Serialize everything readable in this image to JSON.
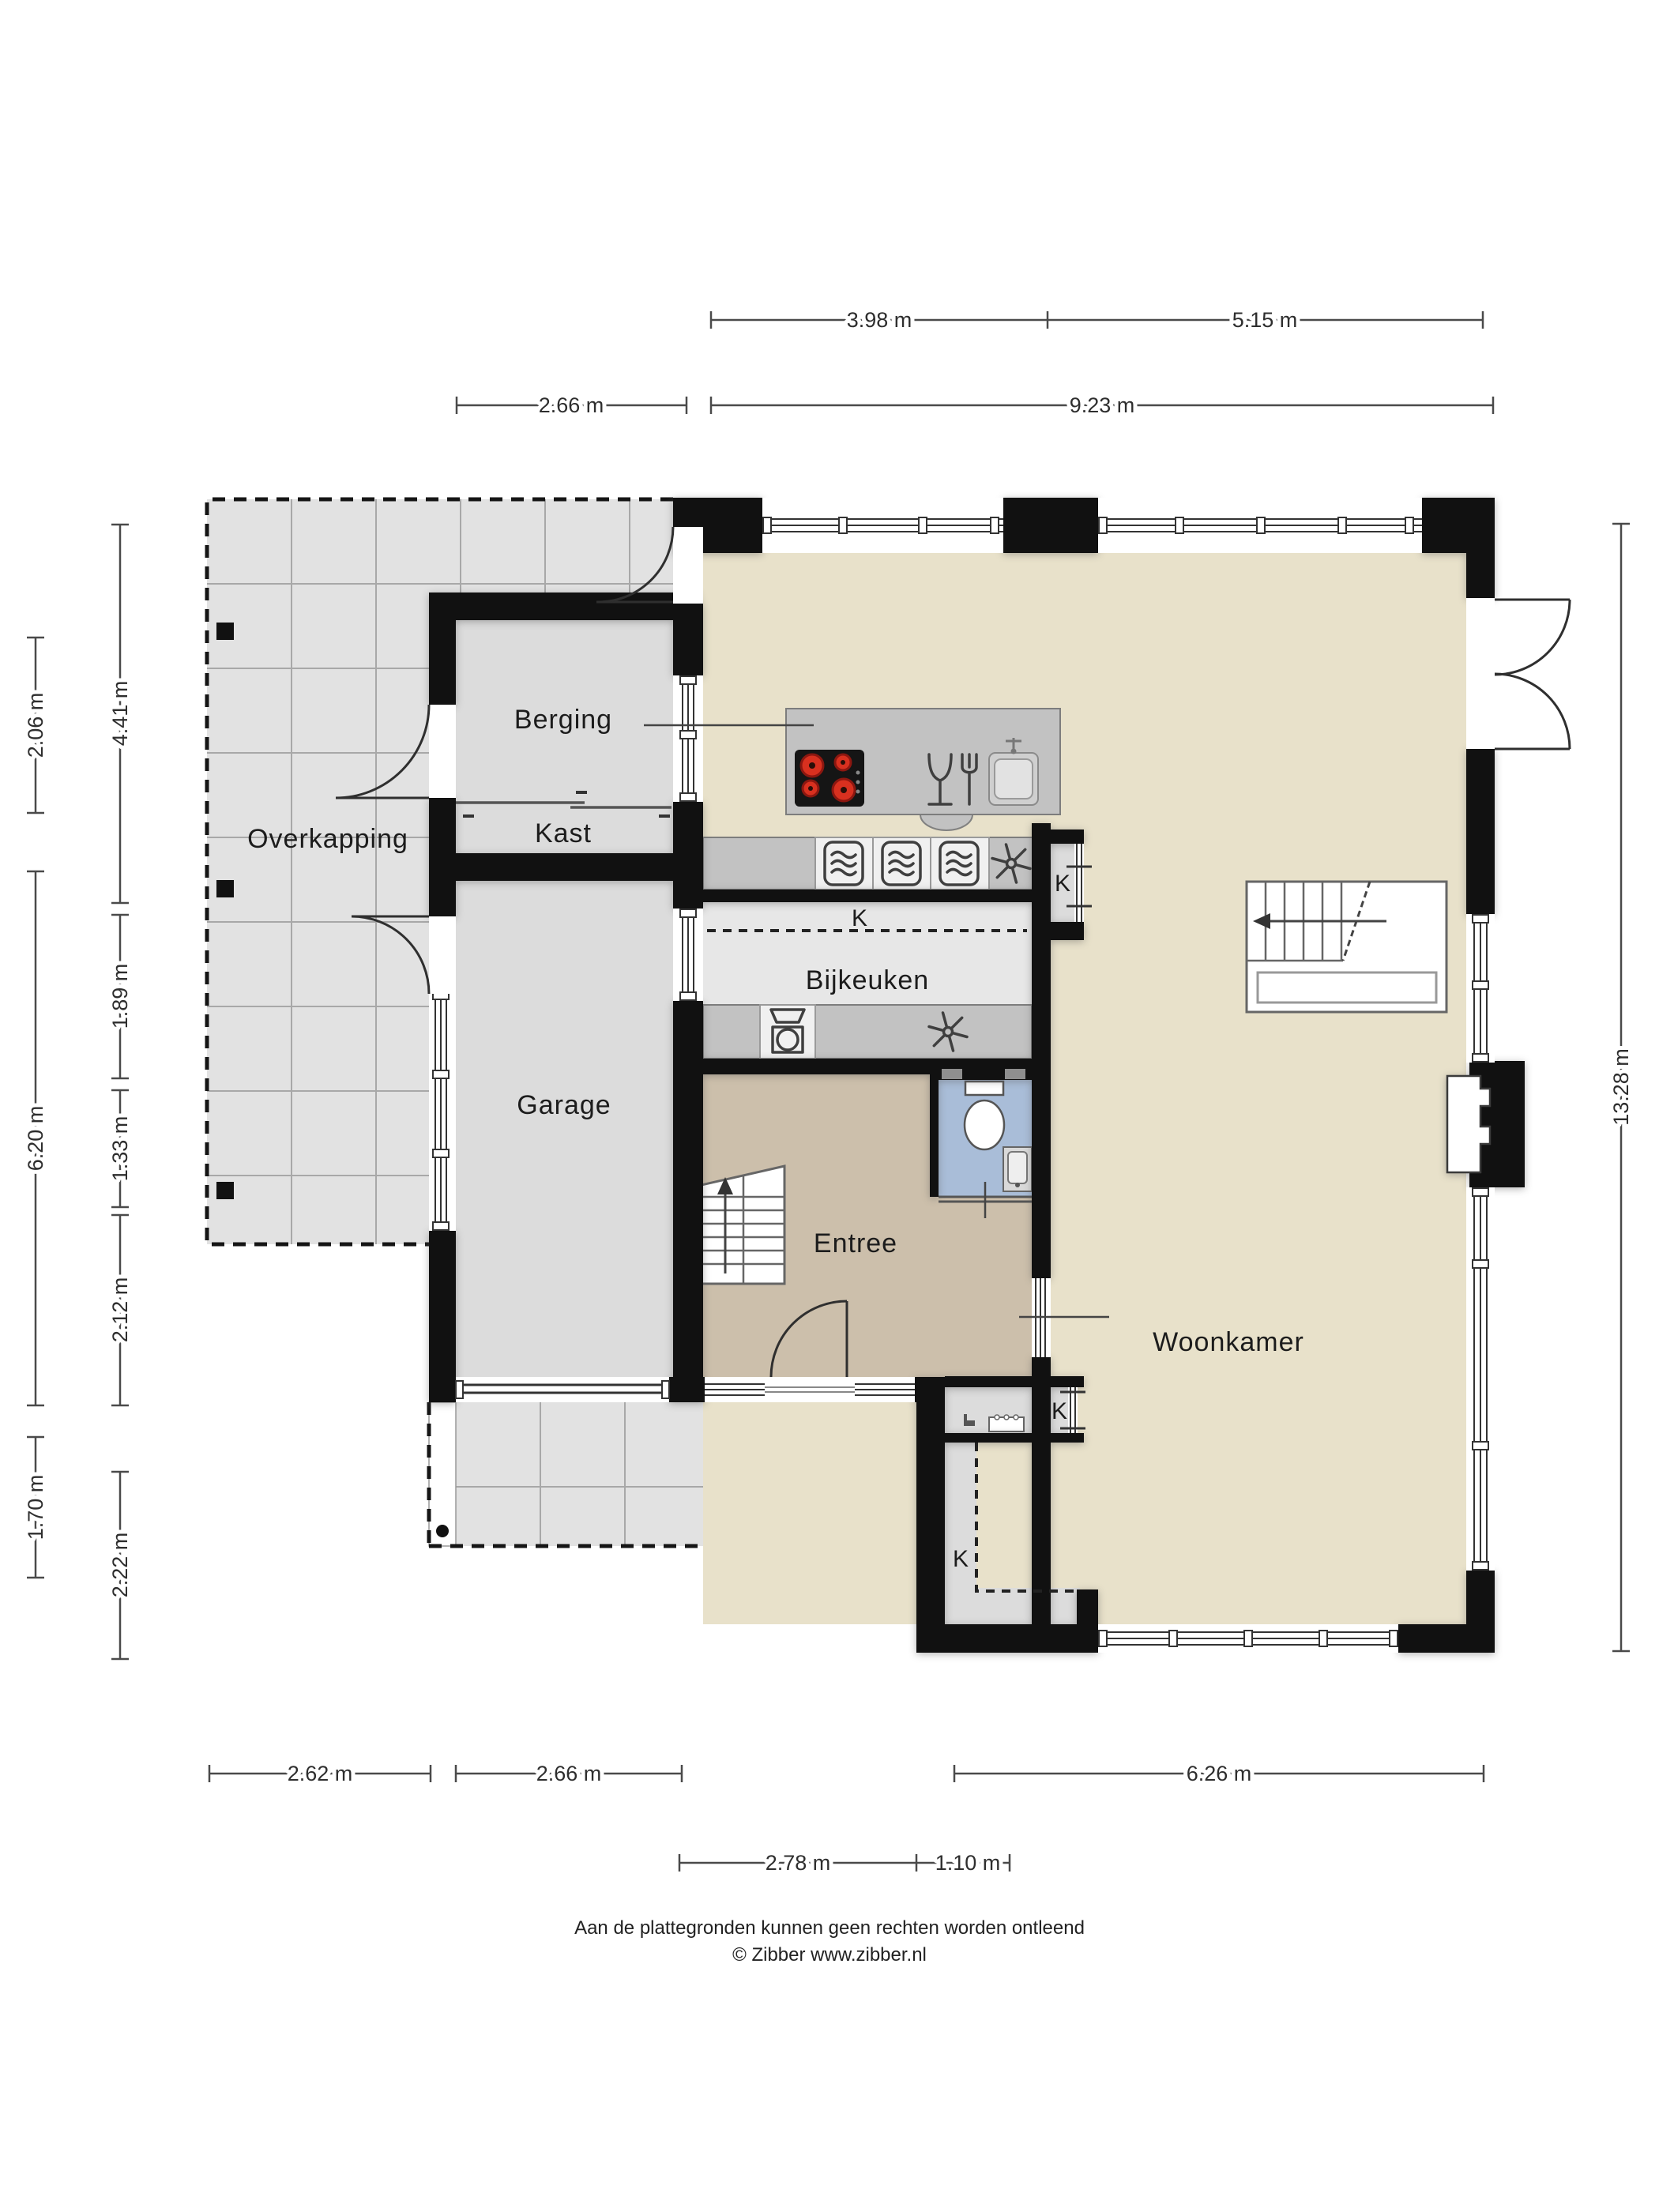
{
  "colors": {
    "wall": "#111111",
    "label": "#1c1c1c",
    "floor-living": "#e8e1ca",
    "floor-gray": "#dcdcdc",
    "floor-light": "#e7e7e7",
    "floor-entree": "#ccbfab",
    "floor-toilet": "#a9bdd8",
    "tile": "#e2e2e2",
    "tile-line": "#a8a8a8",
    "counter": "#c2c2c2",
    "appliance": "#f0f0f0",
    "burner": "#d8301f"
  },
  "rooms": {
    "overkapping": "Overkapping",
    "berging": "Berging",
    "kast": "Kast",
    "garage": "Garage",
    "bijkeuken": "Bijkeuken",
    "entree": "Entree",
    "woonkamer": "Woonkamer",
    "closet_bijkeuken": "K",
    "closet_k1": "K",
    "closet_k2": "K",
    "closet_k3": "K"
  },
  "dimensions": {
    "top_row1": [
      "3.98 m",
      "5.15 m"
    ],
    "top_row2": [
      "2.66 m",
      "9.23 m"
    ],
    "bottom_row1": [
      "2.62 m",
      "2.66 m",
      "6.26 m"
    ],
    "bottom_row2": [
      "2.78 m",
      "1.10 m"
    ],
    "left_outer": [
      "2.06 m",
      "6.20 m",
      "1.70 m"
    ],
    "left_inner": [
      "4.41 m",
      "1.89 m",
      "1.33 m",
      "2.12 m",
      "2.22 m"
    ],
    "right": [
      "13.28 m"
    ]
  },
  "footer": {
    "line1": "Aan de plattegronden kunnen geen rechten worden ontleend",
    "line2": "© Zibber www.zibber.nl"
  }
}
